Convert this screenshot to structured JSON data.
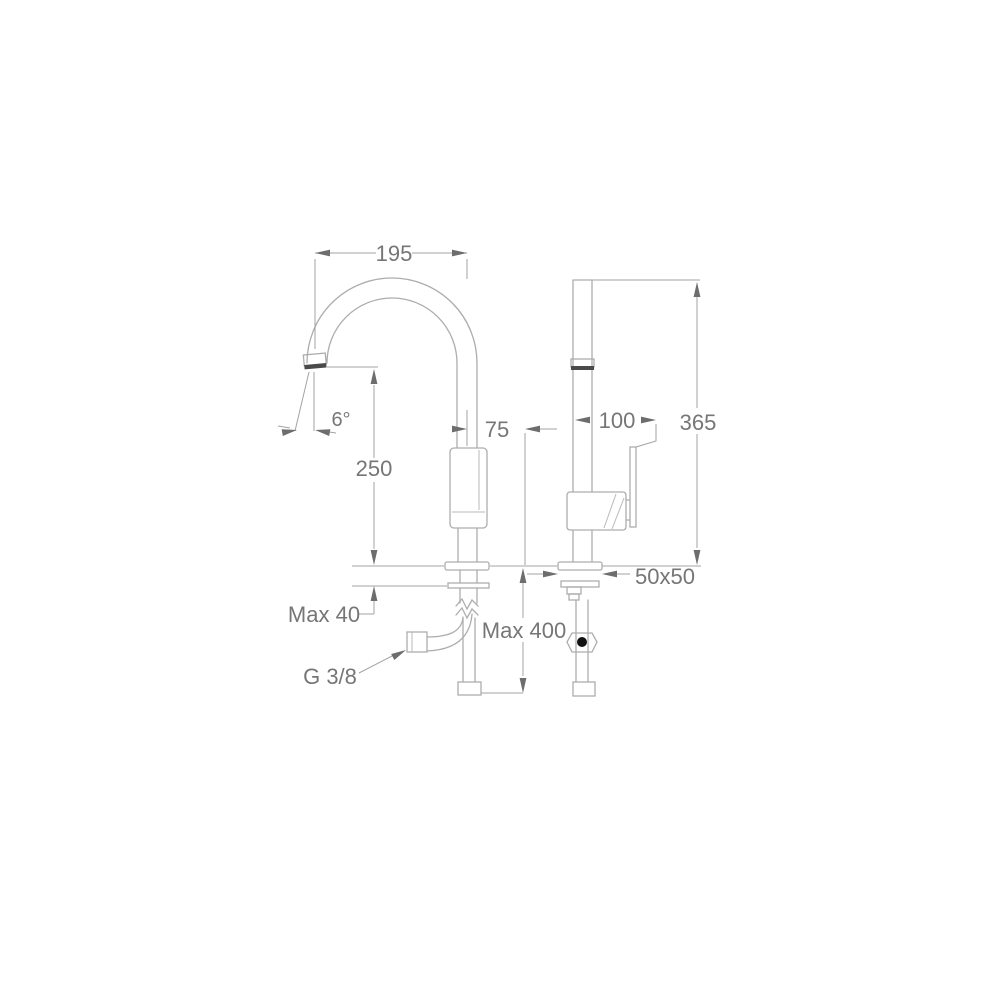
{
  "drawing": {
    "title": "faucet-technical-dimension-drawing",
    "views": [
      "front-view-gooseneck-spout",
      "side-view-with-lever-handle"
    ],
    "background_color": "#ffffff",
    "outline_color": "#adadad",
    "dimension_line_color": "#a3a3a3",
    "text_color": "#767676",
    "accent_dark_color": "#4a4a4a",
    "dot_color": "#111111",
    "labels": {
      "spout_reach": "195",
      "spout_angle": "6°",
      "spout_height": "250",
      "body_offset": "75",
      "handle_length": "100",
      "total_height": "365",
      "max_deck_thickness": "Max 40",
      "connection_thread": "G 3/8",
      "max_hose_length": "Max 400",
      "base_size": "50x50"
    }
  }
}
